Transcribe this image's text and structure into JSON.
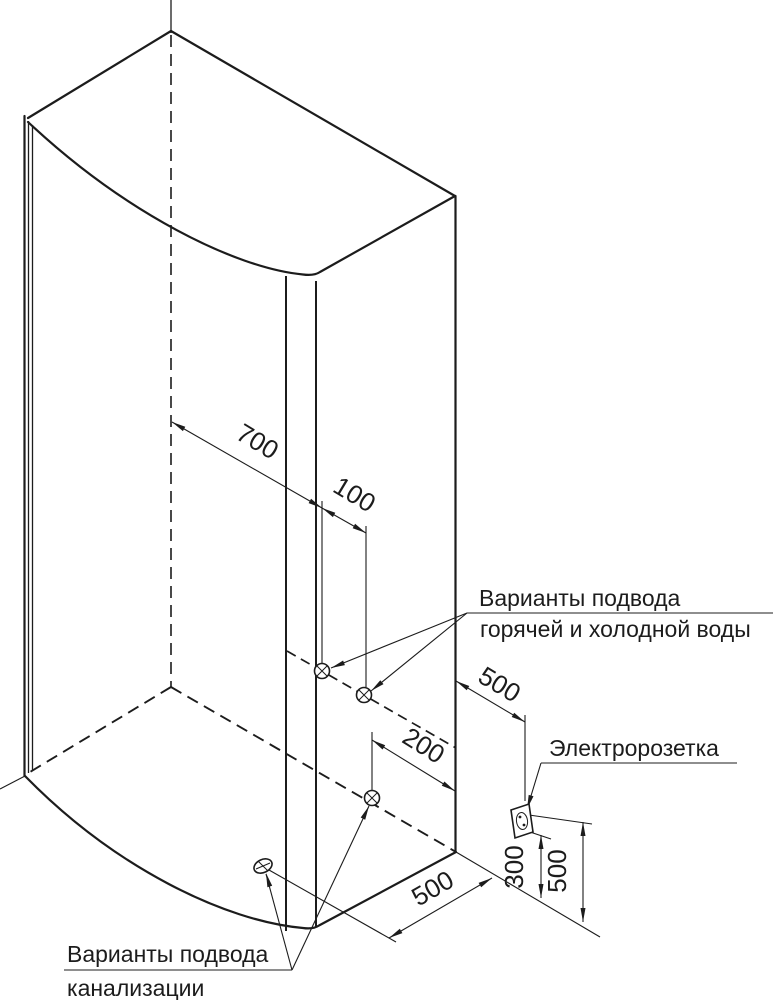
{
  "drawing": {
    "background": "#ffffff",
    "line_color": "#1c1c1c",
    "dims": {
      "axis_to_water": "700",
      "water_spacing": "100",
      "edge_to_socket": "500",
      "drain_to_edge": "200",
      "drain_to_corner": "500",
      "socket_height_lower": "300",
      "socket_height_upper": "500"
    },
    "labels": {
      "water_line1": "Варианты подвода",
      "water_line2": "горячей и холодной воды",
      "socket": "Электророзетка",
      "sewage_line1": "Варианты подвода",
      "sewage_line2": "канализации"
    }
  }
}
